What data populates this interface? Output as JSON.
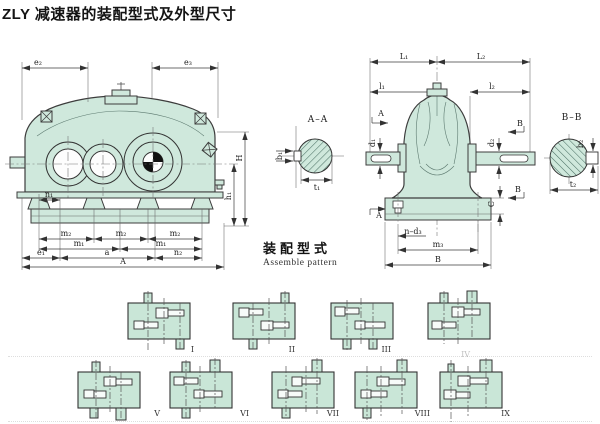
{
  "title": "ZLY 减速器的装配型式及外型尺寸",
  "assemble": {
    "title_cn": "装配型式",
    "title_en": "Assemble pattern"
  },
  "main_view": {
    "e2": "e₂",
    "e3": "e₃",
    "H": "H",
    "h1": "h₁",
    "n1": "n₁",
    "m2": "m₂",
    "m1": "m₁",
    "e1": "e₁",
    "a": "a",
    "n2": "n₂",
    "A": "A"
  },
  "section_aa": {
    "label": "A–A",
    "b1": "b₁",
    "t1": "t₁"
  },
  "end_view": {
    "L1": "L₁",
    "L2": "L₂",
    "l1": "l₁",
    "l2": "l₂",
    "A_marker": "A",
    "B_marker": "B",
    "d1": "d₁",
    "d2": "d₂",
    "C": "C",
    "n_d3": "n–d₃",
    "m3": "m₃",
    "B": "B"
  },
  "section_bb": {
    "label": "B–B",
    "b2": "b₂",
    "t2": "t₂"
  },
  "patterns": [
    {
      "label": "I"
    },
    {
      "label": "II"
    },
    {
      "label": "III"
    },
    {
      "label": "IV"
    },
    {
      "label": "V"
    },
    {
      "label": "VI"
    },
    {
      "label": "VII"
    },
    {
      "label": "VIII"
    },
    {
      "label": "IX"
    }
  ],
  "colors": {
    "housing_fill": "#cfe8dc",
    "pattern_box_fill": "#c9e6d7",
    "line": "#3c3c3c"
  }
}
